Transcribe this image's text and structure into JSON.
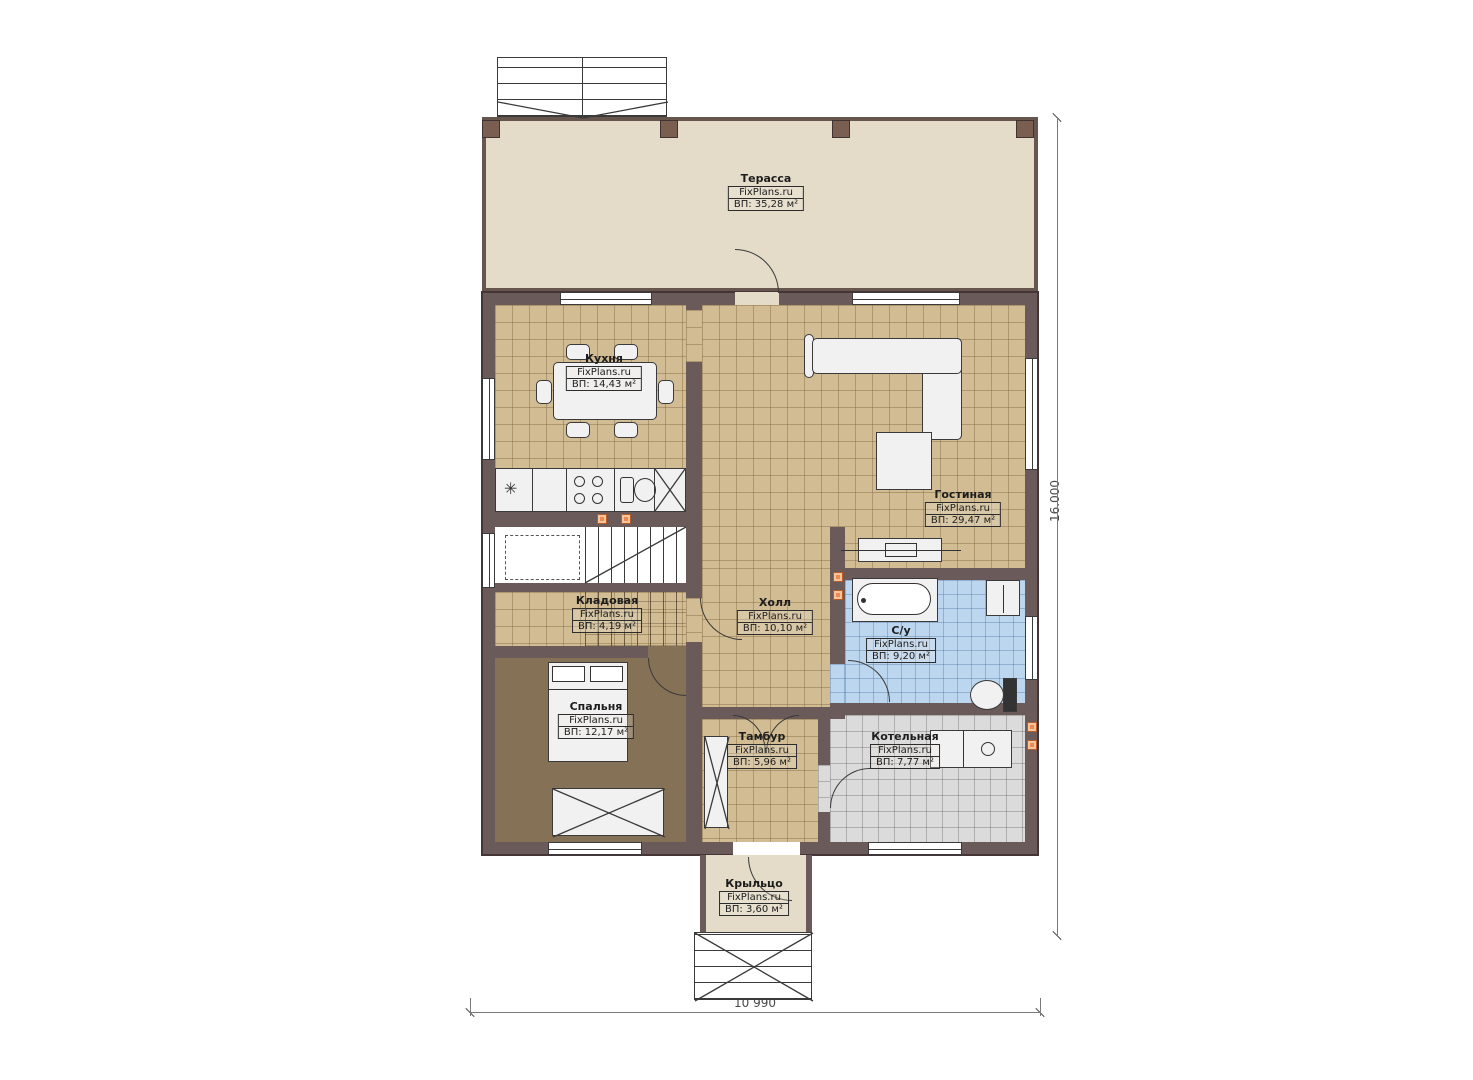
{
  "watermark": "FixPlans.ru",
  "rooms": [
    {
      "name": "Терасса",
      "watermark": "FixPlans.ru",
      "area": "ВП: 35,28 м²",
      "area_m2": 35.28
    },
    {
      "name": "Кухня",
      "watermark": "FixPlans.ru",
      "area": "ВП: 14,43 м²",
      "area_m2": 14.43
    },
    {
      "name": "Гостиная",
      "watermark": "FixPlans.ru",
      "area": "ВП: 29,47 м²",
      "area_m2": 29.47
    },
    {
      "name": "Холл",
      "watermark": "FixPlans.ru",
      "area": "ВП: 10,10 м²",
      "area_m2": 10.1
    },
    {
      "name": "Кладовая",
      "watermark": "FixPlans.ru",
      "area": "ВП: 4,19 м²",
      "area_m2": 4.19
    },
    {
      "name": "Спальня",
      "watermark": "FixPlans.ru",
      "area": "ВП: 12,17 м²",
      "area_m2": 12.17
    },
    {
      "name": "С/у",
      "watermark": "FixPlans.ru",
      "area": "ВП: 9,20 м²",
      "area_m2": 9.2
    },
    {
      "name": "Тамбур",
      "watermark": "FixPlans.ru",
      "area": "ВП: 5,96 м²",
      "area_m2": 5.96
    },
    {
      "name": "Котельная",
      "watermark": "FixPlans.ru",
      "area": "ВП: 7,77 м²",
      "area_m2": 7.77
    },
    {
      "name": "Крыльцо",
      "watermark": "FixPlans.ru",
      "area": "ВП: 3,60 м²",
      "area_m2": 3.6
    }
  ],
  "dimensions": {
    "bottom": "10 990",
    "right": "16.000"
  },
  "colors": {
    "wall": "#6b5a5a",
    "floor_tile_tan": "#d2bc93",
    "floor_terrace": "#e4dcc8",
    "floor_bedroom": "#857156",
    "floor_bath": "#bcd6f0",
    "floor_boiler": "#dbdbdb",
    "socket_orange": "#ee8a4f"
  }
}
